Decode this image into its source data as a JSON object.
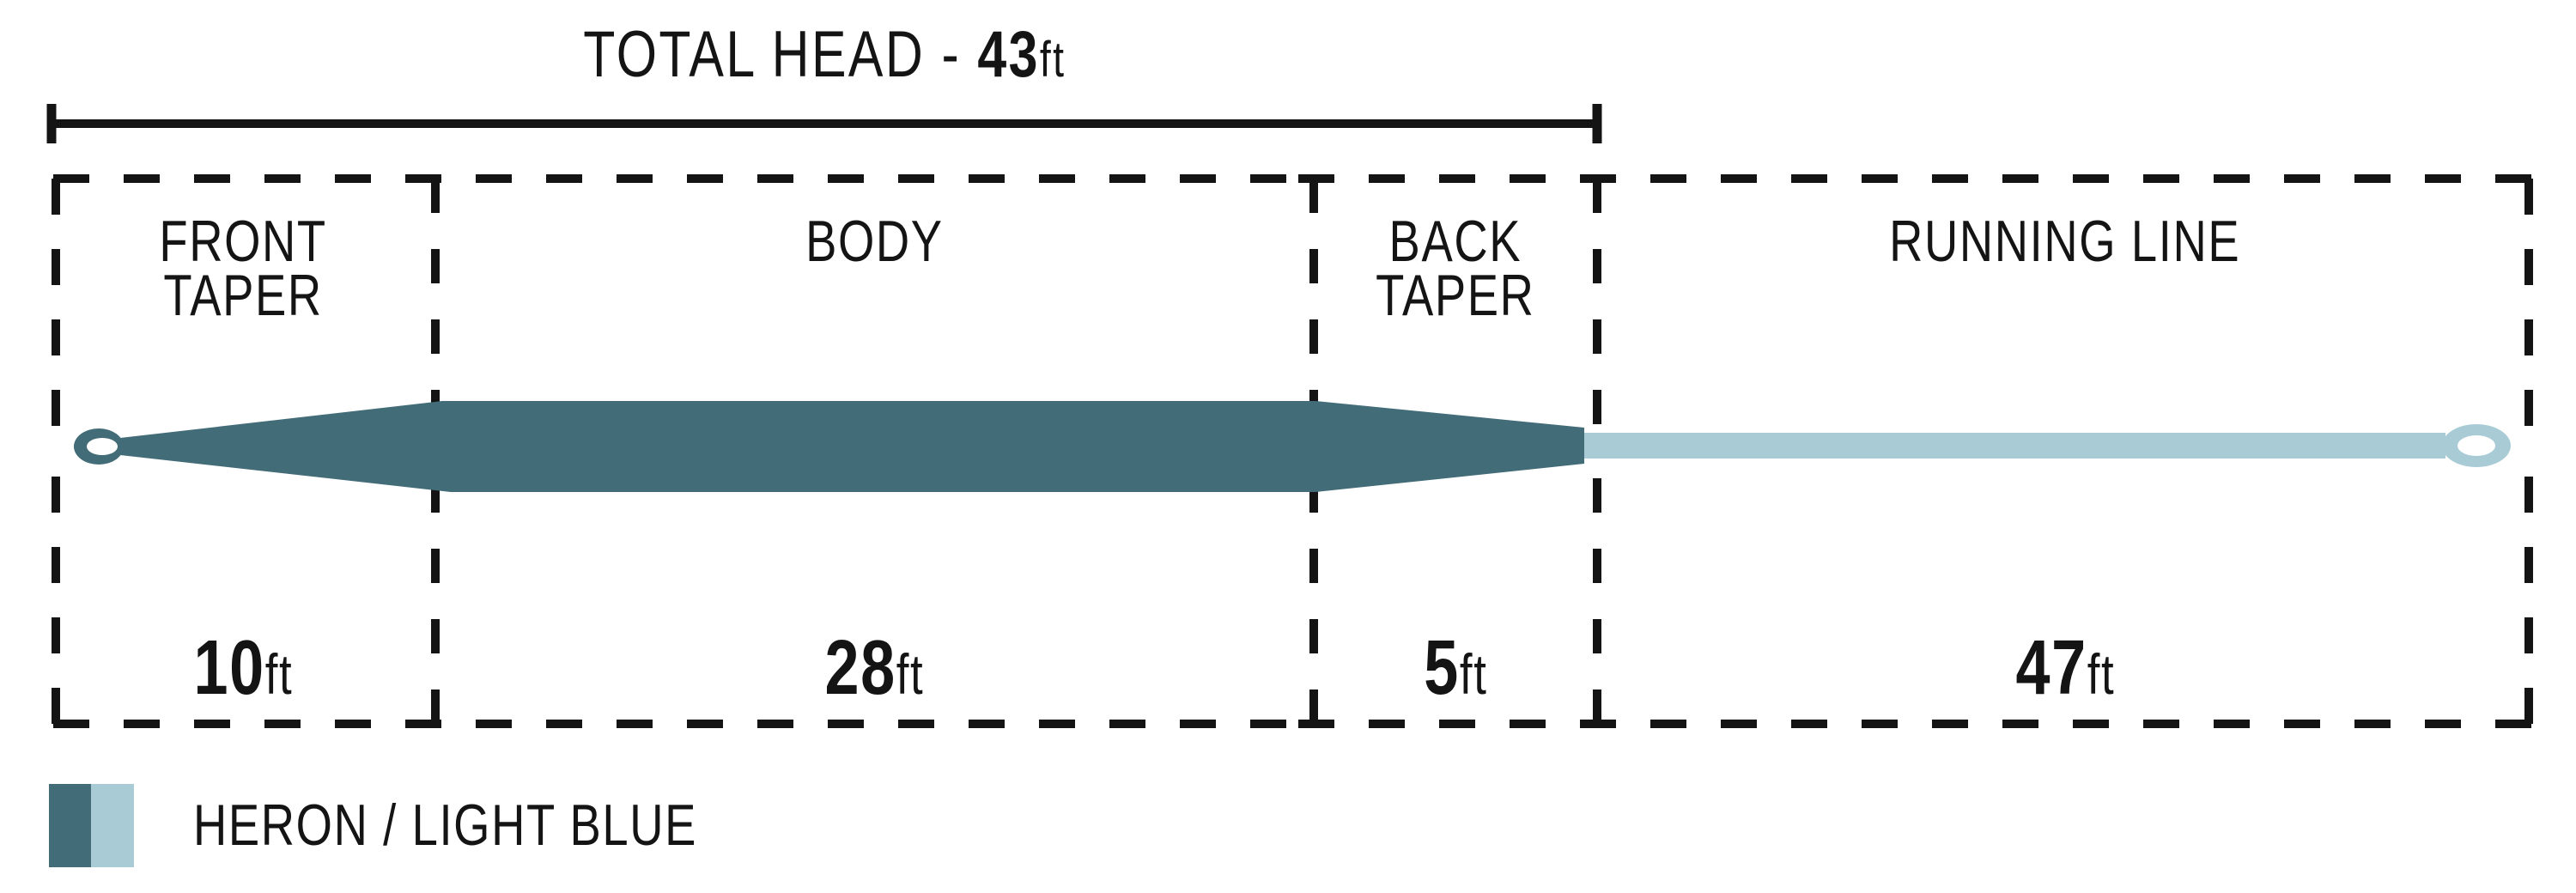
{
  "title": {
    "prefix": "TOTAL HEAD - ",
    "value": "43",
    "unit": "ft"
  },
  "sections": [
    {
      "name": "front-taper",
      "label_lines": [
        "FRONT",
        "TAPER"
      ],
      "length_value": "10",
      "length_unit": "ft"
    },
    {
      "name": "body",
      "label_lines": [
        "BODY"
      ],
      "length_value": "28",
      "length_unit": "ft"
    },
    {
      "name": "back-taper",
      "label_lines": [
        "BACK",
        "TAPER"
      ],
      "length_value": "5",
      "length_unit": "ft"
    },
    {
      "name": "running-line",
      "label_lines": [
        "RUNNING LINE"
      ],
      "length_value": "47",
      "length_unit": "ft"
    }
  ],
  "legend": {
    "label": "HERON / LIGHT BLUE",
    "colors": {
      "heron": "#426C77",
      "light_blue": "#A8CBD6",
      "ink": "#141414"
    }
  }
}
